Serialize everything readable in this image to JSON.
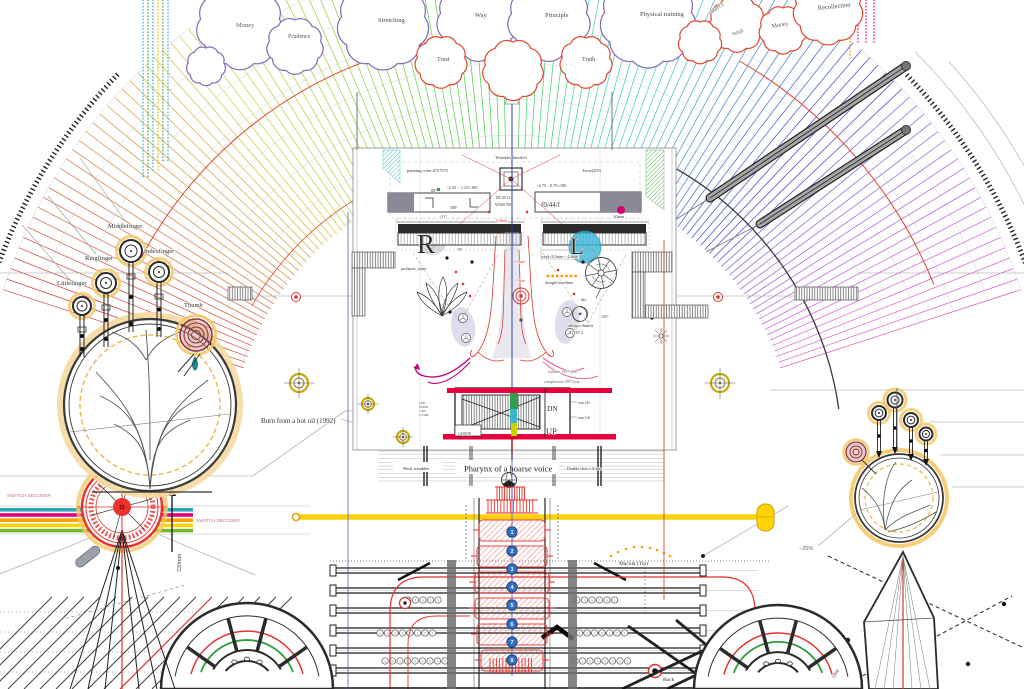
{
  "meta": {
    "title": "Anatomical blueprint diagram"
  },
  "palette": {
    "accent_red": "#e8322d",
    "magenta": "#e5007d",
    "yellow_bar": "#f7cf00",
    "blue_line": "#2b3fae",
    "cyan": "#35b6d9",
    "teal": "#2aa7b2",
    "green": "#4faa44",
    "orange": "#f5a300",
    "purple_cloud": "#8468b8",
    "red_cloud": "#e0452b",
    "halo_orange": "#f5c96a",
    "spine_blue": "#2f6fc4"
  },
  "fan": {
    "cx": 512,
    "cy": 455,
    "rInner": 282,
    "rOuter": 535,
    "aStart": 18,
    "aEnd": 162,
    "step": 1.2,
    "arcRadii": [
      285,
      320,
      356,
      392,
      428,
      464,
      500,
      535
    ],
    "tickR": 548,
    "tickRanges": [
      [
        136,
        163
      ],
      [
        17,
        44
      ]
    ],
    "outerArcs": [
      [
        570,
        20,
        45
      ],
      [
        588,
        22,
        42
      ]
    ],
    "accentArcs": [
      {
        "r": 420,
        "a1": 95,
        "a2": 152,
        "c": "#e0452b",
        "w": 1
      },
      {
        "r": 455,
        "a1": 22,
        "a2": 60,
        "c": "#e0452b",
        "w": 1
      },
      {
        "r": 330,
        "a1": 8,
        "a2": 60,
        "c": "#3a3a3a",
        "w": 1.3
      },
      {
        "r": 300,
        "a1": 100,
        "a2": 150,
        "c": "#e0452b",
        "w": 0.8
      }
    ]
  },
  "dottedColumns": [
    {
      "x": 143,
      "c": "#35b6d9",
      "y1": 0,
      "y2": 178
    },
    {
      "x": 148,
      "c": "#4faa44",
      "y1": 0,
      "y2": 178
    },
    {
      "x": 153,
      "c": "#35b6d9",
      "y1": 0,
      "y2": 170
    },
    {
      "x": 158,
      "c": "#e0c000",
      "y1": 0,
      "y2": 170
    },
    {
      "x": 163,
      "c": "#4faa44",
      "y1": 0,
      "y2": 162
    },
    {
      "x": 168,
      "c": "#35b6d9",
      "y1": 0,
      "y2": 162
    },
    {
      "x": 850,
      "c": "#f5a300",
      "y1": 0,
      "y2": 60
    },
    {
      "x": 858,
      "c": "#e5007d",
      "y1": 0,
      "y2": 42
    },
    {
      "x": 866,
      "c": "#e5007d",
      "y1": 0,
      "y2": 42
    },
    {
      "x": 874,
      "c": "#e5007d",
      "y1": 0,
      "y2": 42
    }
  ],
  "clouds": [
    {
      "x": 240,
      "y": 26,
      "r": 40,
      "s": "#8468b8"
    },
    {
      "x": 295,
      "y": 46,
      "r": 26,
      "s": "#8468b8"
    },
    {
      "x": 383,
      "y": 24,
      "r": 42,
      "s": "#8468b8"
    },
    {
      "x": 478,
      "y": 20,
      "r": 38,
      "s": "#8468b8"
    },
    {
      "x": 549,
      "y": 20,
      "r": 38,
      "s": "#8468b8"
    },
    {
      "x": 648,
      "y": 20,
      "r": 44,
      "s": "#8468b8"
    },
    {
      "x": 206,
      "y": 66,
      "r": 18,
      "s": "#8468b8"
    },
    {
      "x": 737,
      "y": 24,
      "r": 26,
      "s": "#e0452b"
    },
    {
      "x": 783,
      "y": 30,
      "r": 22,
      "s": "#e0452b"
    },
    {
      "x": 828,
      "y": 10,
      "r": 32,
      "s": "#e0452b"
    },
    {
      "x": 700,
      "y": 42,
      "r": 20,
      "s": "#e0452b"
    },
    {
      "x": 441,
      "y": 62,
      "r": 24,
      "s": "#e0452b"
    },
    {
      "x": 586,
      "y": 62,
      "r": 24,
      "s": "#e0452b"
    },
    {
      "x": 513,
      "y": 70,
      "r": 28,
      "s": "#e0452b"
    }
  ],
  "stripes": {
    "x1": 0,
    "x2": 193,
    "yTop": 508,
    "h": 3.6,
    "gap": 1.6,
    "colors": [
      "#2aa7b2",
      "#e5007d",
      "#f5a300",
      "#ffd400",
      "#76b82a"
    ]
  },
  "spine": {
    "x": 512,
    "numbers": [
      "1",
      "2",
      "3",
      "4",
      "5",
      "6",
      "7",
      "8"
    ],
    "ys": [
      532,
      551,
      569,
      587,
      605,
      624,
      642,
      660
    ]
  },
  "deck": {
    "pairYs": [
      568,
      588,
      608,
      628,
      648,
      668
    ],
    "x1": 332,
    "x2": 705,
    "digit": "5",
    "numberRows": [
      {
        "x": 408,
        "y": 600,
        "n": 5
      },
      {
        "x": 380,
        "y": 633,
        "n": 8
      },
      {
        "x": 385,
        "y": 661,
        "n": 9
      },
      {
        "x": 577,
        "y": 600,
        "n": 6
      },
      {
        "x": 572,
        "y": 633,
        "n": 8
      },
      {
        "x": 575,
        "y": 661,
        "n": 8
      }
    ]
  },
  "labels": {
    "neck_wrinkles": "Neck wrinkles",
    "pharynx": "Pharynx of a hoarse voice",
    "double_chin": "Double chin = S-line"
  },
  "annotations": [
    {
      "n": "label-money-left",
      "t": "Money",
      "x": 236,
      "y": 27,
      "s": 6.5,
      "c": "#5a5a5a"
    },
    {
      "n": "label-prudence",
      "t": "Prudence",
      "x": 288,
      "y": 38,
      "s": 6,
      "c": "#5a5a5a"
    },
    {
      "n": "label-stretching",
      "t": "Stretching",
      "x": 378,
      "y": 22,
      "s": 6.5,
      "c": "#4a4a4a"
    },
    {
      "n": "label-way",
      "t": "Way",
      "x": 475,
      "y": 17,
      "s": 6.5,
      "c": "#4a4a4a"
    },
    {
      "n": "label-principle",
      "t": "Principle",
      "x": 545,
      "y": 17,
      "s": 6.5,
      "c": "#4a4a4a"
    },
    {
      "n": "label-physical-training",
      "t": "Physical training",
      "x": 640,
      "y": 16,
      "s": 6.5,
      "c": "#4a4a4a"
    },
    {
      "n": "label-mercy",
      "t": "Mercy",
      "x": 712,
      "y": 14,
      "s": 6,
      "c": "#5a5a5a",
      "r": -38
    },
    {
      "n": "label-money-right",
      "t": "Money",
      "x": 772,
      "y": 28,
      "s": 6,
      "c": "#5a5a5a",
      "r": -10
    },
    {
      "n": "label-wish",
      "t": "Wish",
      "x": 733,
      "y": 36,
      "s": 5.5,
      "c": "#5a5a5a",
      "r": -22
    },
    {
      "n": "label-recollection",
      "t": "Recollection",
      "x": 818,
      "y": 10,
      "s": 6.5,
      "c": "#4a4a4a",
      "r": -6
    },
    {
      "n": "label-trust",
      "t": "Trust",
      "x": 437,
      "y": 61,
      "s": 6,
      "c": "#4a4a4a"
    },
    {
      "n": "label-truth",
      "t": "Truth",
      "x": 582,
      "y": 61,
      "s": 6,
      "c": "#4a4a4a"
    },
    {
      "n": "label-littlefinger",
      "t": "Littlefinger",
      "x": 57,
      "y": 285,
      "s": 6.5
    },
    {
      "n": "label-ringfinger",
      "t": "Ringfinger",
      "x": 85,
      "y": 260,
      "s": 6.5
    },
    {
      "n": "label-middlefinger",
      "t": "Middlefinger",
      "x": 108,
      "y": 228,
      "s": 6.5
    },
    {
      "n": "label-indexfinger",
      "t": "Indexfinger",
      "x": 144,
      "y": 253,
      "s": 6.5
    },
    {
      "n": "label-thumb",
      "t": "Thumb",
      "x": 184,
      "y": 307,
      "s": 6.5
    },
    {
      "n": "label-swatch-top",
      "t": "SWATCH.DECODER",
      "x": 7,
      "y": 497,
      "s": 4.6,
      "c": "#c47084",
      "f": "san"
    },
    {
      "n": "label-swatch-bottom",
      "t": "SWATCH.DECODER.",
      "x": 196,
      "y": 522,
      "s": 4.6,
      "c": "#c47084",
      "f": "san"
    },
    {
      "n": "label-220mm",
      "t": "220mm",
      "x": 181,
      "y": 572,
      "s": 6,
      "c": "#4a4a4a",
      "r": -90
    },
    {
      "n": "label-burn",
      "t": "Burn from a hot oil (1992)",
      "x": 261,
      "y": 423,
      "s": 7
    },
    {
      "n": "label-wrinkles-knurled",
      "t": "Wrinkles knurled",
      "x": 511,
      "y": 159,
      "s": 4.5,
      "a": "middle"
    },
    {
      "n": "label-painting-color",
      "t": "painting color #757575",
      "x": 407,
      "y": 172,
      "s": 4.4
    },
    {
      "n": "label-rx-left",
      "t": "−4.35 − 1.25×180",
      "x": 446,
      "y": 189,
      "s": 4.4
    },
    {
      "n": "label-rx-right",
      "t": "−4.75 −0.75×180",
      "x": 536,
      "y": 187,
      "s": 4.4
    },
    {
      "n": "label-twist",
      "t": "Twist(205)",
      "x": 582,
      "y": 172,
      "s": 4.4
    },
    {
      "n": "label-deg80",
      "t": "80°",
      "x": 431,
      "y": 192,
      "s": 4
    },
    {
      "n": "label-dt0514",
      "t": "DT.05.14",
      "x": 496,
      "y": 199,
      "s": 3.9
    },
    {
      "n": "label-w500700",
      "t": "W500.700",
      "x": 495,
      "y": 206,
      "s": 3.9
    },
    {
      "n": "label-f044f",
      "t": "f0/44/f",
      "x": 541,
      "y": 207,
      "s": 7,
      "c": "#3a3a3a"
    },
    {
      "n": "label-deg180",
      "t": "180°",
      "x": 450,
      "y": 209,
      "s": 4
    },
    {
      "n": "label-deg-51",
      "t": "−51°",
      "x": 439,
      "y": 218,
      "s": 4
    },
    {
      "n": "label-4-0mm",
      "t": "4.0mm",
      "x": 496,
      "y": 222,
      "s": 4,
      "c": "#e8322d"
    },
    {
      "n": "label-62mm",
      "t": "62mm",
      "x": 614,
      "y": 218,
      "s": 4
    },
    {
      "n": "label-deg70",
      "t": "70°",
      "x": 457,
      "y": 251,
      "s": 4
    },
    {
      "n": "label-eye-right-letter",
      "t": "R",
      "x": 417,
      "y": 253,
      "s": 27,
      "c": "#2f2f2f"
    },
    {
      "n": "label-eye-left-letter",
      "t": "L",
      "x": 570,
      "y": 254,
      "s": 23,
      "c": "#2f2f2f"
    },
    {
      "n": "label-prolapsis",
      "t": "prolapsis_wiper",
      "x": 401,
      "y": 270,
      "s": 4
    },
    {
      "n": "label-weak",
      "t": "weak (0.5mm ~ 4.0mm)",
      "x": 541,
      "y": 258,
      "s": 4
    },
    {
      "n": "label-thought-bent",
      "t": "thought bent 2mm",
      "x": 545,
      "y": 284,
      "s": 3.8
    },
    {
      "n": "label-dry",
      "t": "dry",
      "x": 581,
      "y": 301,
      "s": 4
    },
    {
      "n": "label-allergic",
      "t": "allergic rhinitis",
      "x": 568,
      "y": 327,
      "s": 4.2
    },
    {
      "n": "label-dt072",
      "t": "DT.07.2",
      "x": 570,
      "y": 334,
      "s": 4
    },
    {
      "n": "label-deg135",
      "t": "135°",
      "x": 601,
      "y": 318,
      "s": 4
    },
    {
      "n": "label-2-0mm",
      "t": "2.0mm",
      "x": 514,
      "y": 263,
      "s": 3.8,
      "c": "#e8322d"
    },
    {
      "n": "label-1-5mm",
      "t": "1.5mm",
      "x": 514,
      "y": 282,
      "s": 3.8,
      "c": "#e8322d"
    },
    {
      "n": "label-wrinkle-year",
      "t": "wrinkle 1997/year",
      "x": 548,
      "y": 373,
      "s": 4,
      "c": "#666666"
    },
    {
      "n": "label-complexion-year",
      "t": "complexion 1997/year",
      "x": 544,
      "y": 383,
      "s": 4,
      "c": "#666666"
    },
    {
      "n": "label-dn",
      "t": "DN",
      "x": 547,
      "y": 411,
      "s": 7.5
    },
    {
      "n": "label-up",
      "t": "UP",
      "x": 546,
      "y": 434,
      "s": 8.5
    },
    {
      "n": "label-datebox",
      "t": "14/05/W",
      "x": 458,
      "y": 435,
      "s": 3.8
    },
    {
      "n": "label-was16",
      "t": "was.16+",
      "x": 578,
      "y": 404,
      "s": 3.8
    },
    {
      "n": "label-was14",
      "t": "was.14+",
      "x": 578,
      "y": 419,
      "s": 3.8
    },
    {
      "n": "label-cur",
      "t": "CUR",
      "x": 419,
      "y": 404,
      "s": 3
    },
    {
      "n": "label-scion",
      "t": "SCION",
      "x": 419,
      "y": 408,
      "s": 3
    },
    {
      "n": "label-v2n",
      "t": "V-2N",
      "x": 419,
      "y": 412,
      "s": 3
    },
    {
      "n": "label-ccaw",
      "t": "C-CAW",
      "x": 419,
      "y": 416,
      "s": 3
    },
    {
      "n": "label-macula",
      "t": "Macula (Tip)",
      "x": 619,
      "y": 565,
      "s": 5.5
    },
    {
      "n": "label-minus25",
      "t": "−25%",
      "x": 799,
      "y": 550,
      "s": 5.5,
      "c": "#666666",
      "f": "san"
    },
    {
      "n": "label-back",
      "t": "Back",
      "x": 663,
      "y": 681,
      "s": 5.5
    },
    {
      "n": "label-1988",
      "t": "1988",
      "x": 834,
      "y": 679,
      "s": 5,
      "c": "#555555",
      "r": -58
    }
  ]
}
